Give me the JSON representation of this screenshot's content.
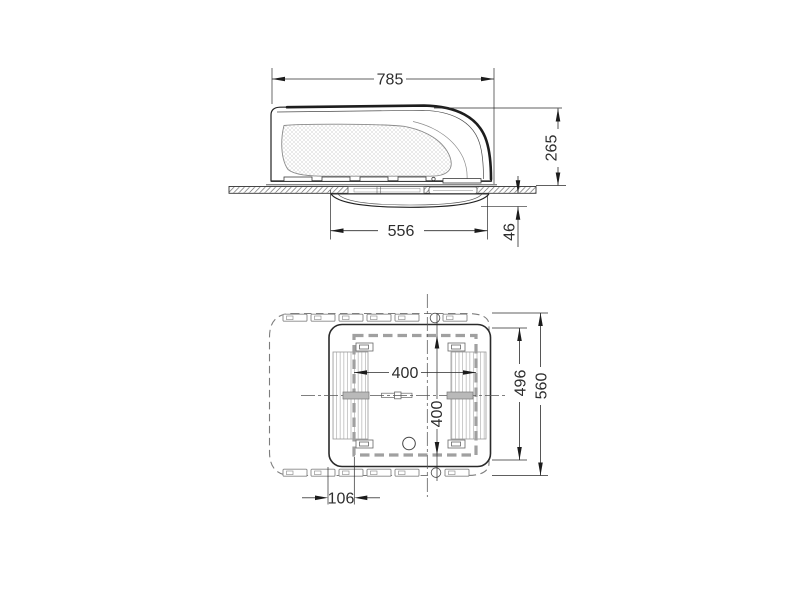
{
  "page": {
    "background": "#ffffff"
  },
  "drawing": {
    "kind": "technical-dimension-drawing",
    "unit_system": "mm",
    "colors": {
      "line": "#222222",
      "dim_text": "#2e2e2e",
      "hidden_outline": "#7d7d7d",
      "cutout_dash": "#a0a0a0"
    },
    "side_view": {
      "dims": {
        "overall_length": "785",
        "overall_height": "265",
        "ceiling_unit_length": "556",
        "ceiling_unit_drop": "46"
      }
    },
    "plan_view": {
      "dims": {
        "cutout_width": "400",
        "cutout_length": "400",
        "inner_frame_width": "496",
        "unit_body_width": "560",
        "side_offset": "106"
      }
    }
  }
}
